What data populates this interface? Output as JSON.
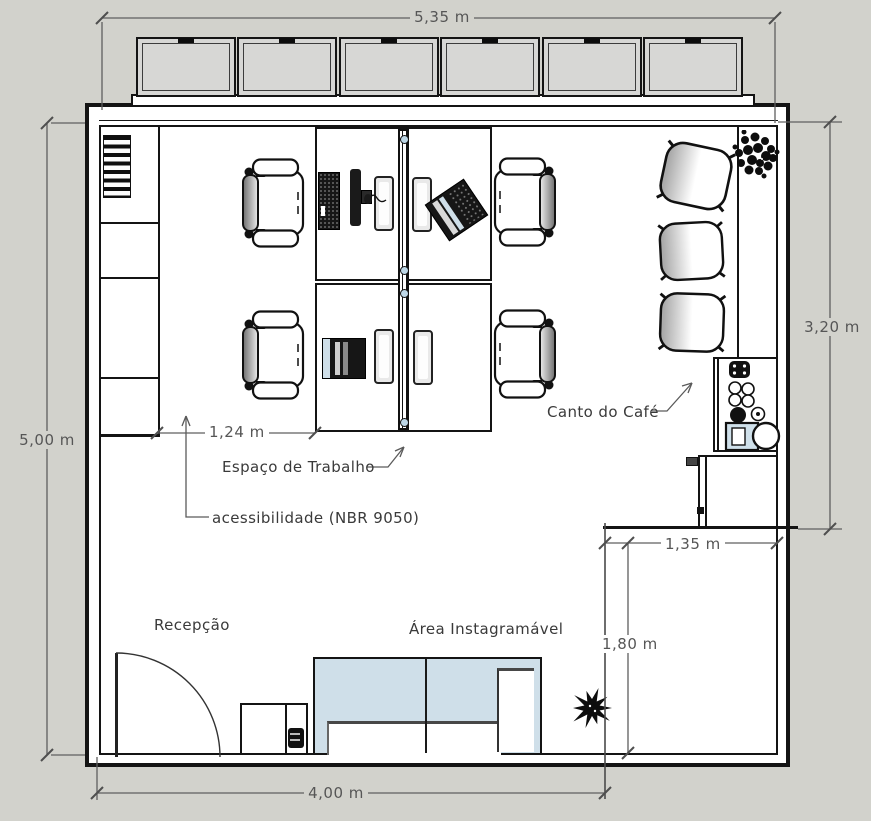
{
  "drawing": {
    "title": "office floor plan",
    "dimensions": {
      "width_top": "5,35 m",
      "height_left": "5,00 m",
      "height_right": "3,20 m",
      "width_bottom": "4,00 m",
      "niche_width": "1,35 m",
      "niche_depth": "1,80 m",
      "aisle_width": "1,24 m"
    },
    "labels": {
      "workspace": "Espaço de Trabalho",
      "accessibility": "acessibilidade (NBR 9050)",
      "coffee_corner": "Canto do Café",
      "reception": "Recepção",
      "instagram_area": "Área Instagramável"
    },
    "colors": {
      "background": "#d2d2cc",
      "floor": "#ffffff",
      "wall_line": "#141414",
      "dimension_line": "#5f5f5f",
      "sofa_blue": "#cfdfe9",
      "window_glass": "#d7d7d5",
      "knob_blue": "#bdd7e7"
    },
    "objects": [
      "window-band",
      "storage-shelf",
      "workstation-desks",
      "office-chairs",
      "lounge-armchairs",
      "coffee-counter",
      "coffee-station",
      "fridge-cabinet",
      "reception-cabinet",
      "entrance-door",
      "l-shaped-sofa",
      "plants"
    ]
  }
}
